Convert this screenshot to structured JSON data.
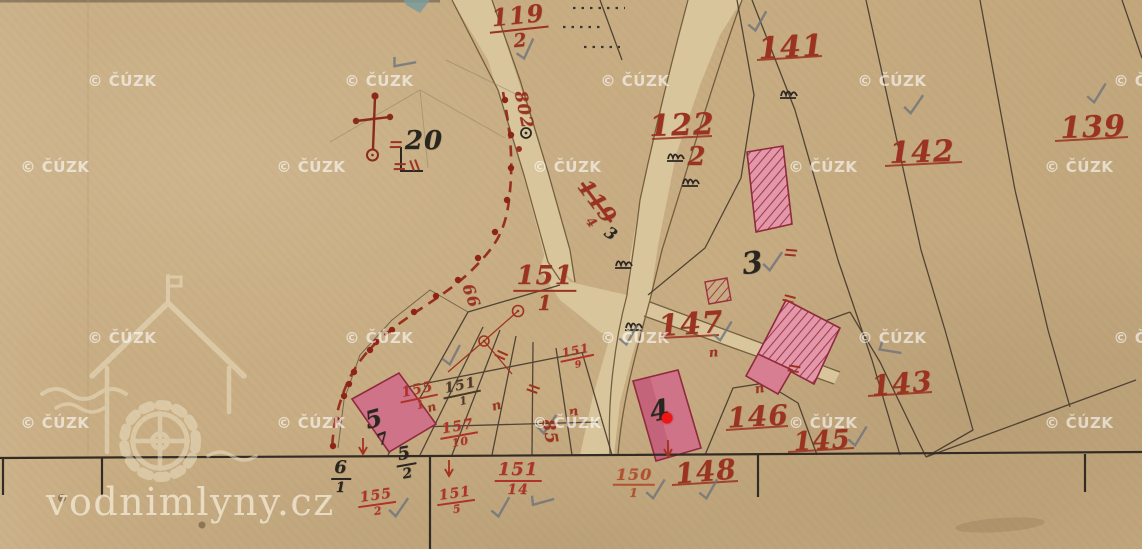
{
  "brand": {
    "text": "vodnimlyny.cz"
  },
  "watermarks": {
    "text": "© ČÚZK",
    "positions": [
      [
        122,
        81
      ],
      [
        379,
        81
      ],
      [
        635,
        81
      ],
      [
        892,
        81
      ],
      [
        1148,
        81
      ],
      [
        55,
        167
      ],
      [
        311,
        167
      ],
      [
        567,
        167
      ],
      [
        823,
        167
      ],
      [
        1079,
        167
      ],
      [
        122,
        338
      ],
      [
        379,
        338
      ],
      [
        635,
        338
      ],
      [
        892,
        338
      ],
      [
        1148,
        338
      ],
      [
        55,
        423
      ],
      [
        311,
        423
      ],
      [
        567,
        423
      ],
      [
        823,
        423
      ],
      [
        1079,
        423
      ]
    ]
  },
  "marker": {
    "color": "#f01414",
    "x": 667,
    "y": 418
  },
  "colors": {
    "paper": "#c9ae84",
    "road": "#d9c59c",
    "ink_red": "#9c3320",
    "ink_black": "#2c2722",
    "building_pink": "#d77e93",
    "building_outline": "#8e2b3c",
    "pencil_grey": "#6e747b",
    "marker_red": "#f01414",
    "watermark_white": "#ffffff"
  },
  "map": {
    "labels": [
      {
        "text": "20",
        "x": 424,
        "y": 141,
        "s": 26,
        "cls": "black"
      },
      {
        "frac": [
          "119",
          "2"
        ],
        "x": 519,
        "y": 27,
        "s": 24,
        "cls": "red",
        "r": -6
      },
      {
        "text": "141",
        "x": 791,
        "y": 48,
        "s": 30,
        "cls": "red",
        "r": -3
      },
      {
        "text": "122",
        "x": 682,
        "y": 126,
        "s": 30,
        "cls": "red",
        "r": -2
      },
      {
        "text": "2",
        "x": 697,
        "y": 157,
        "s": 26,
        "cls": "red",
        "r": 0
      },
      {
        "text": "142",
        "x": 922,
        "y": 153,
        "s": 30,
        "cls": "red",
        "r": -2
      },
      {
        "text": "139",
        "x": 1093,
        "y": 128,
        "s": 30,
        "cls": "red",
        "r": -2
      },
      {
        "text": "119",
        "x": 597,
        "y": 202,
        "s": 22,
        "cls": "red",
        "r": 53,
        "strike": true
      },
      {
        "text": "4",
        "x": 591,
        "y": 223,
        "s": 13,
        "cls": "red",
        "r": 50
      },
      {
        "text": "3",
        "x": 611,
        "y": 234,
        "s": 16,
        "cls": "black",
        "r": 35
      },
      {
        "text": "802",
        "x": 523,
        "y": 110,
        "s": 17,
        "cls": "red",
        "r": 78
      },
      {
        "frac": [
          "151",
          "1"
        ],
        "x": 545,
        "y": 288,
        "s": 26,
        "cls": "red"
      },
      {
        "text": "3",
        "x": 753,
        "y": 264,
        "s": 30,
        "cls": "black",
        "r": -8
      },
      {
        "text": "147",
        "x": 691,
        "y": 325,
        "s": 30,
        "cls": "red",
        "r": -4
      },
      {
        "text": "66",
        "x": 471,
        "y": 296,
        "s": 16,
        "cls": "red",
        "r": 70
      },
      {
        "text": "143",
        "x": 902,
        "y": 384,
        "s": 28,
        "cls": "red",
        "r": -5
      },
      {
        "text": "146",
        "x": 758,
        "y": 417,
        "s": 28,
        "cls": "red",
        "r": -3
      },
      {
        "text": "145",
        "x": 822,
        "y": 441,
        "s": 26,
        "cls": "red",
        "r": -3
      },
      {
        "text": "148",
        "x": 706,
        "y": 472,
        "s": 28,
        "cls": "red",
        "r": -5
      },
      {
        "frac": [
          "150",
          "1"
        ],
        "x": 634,
        "y": 483,
        "s": 16,
        "cls": "orange"
      },
      {
        "frac": [
          "151",
          "14"
        ],
        "x": 518,
        "y": 479,
        "s": 18,
        "cls": "crimson"
      },
      {
        "frac": [
          "151",
          "5"
        ],
        "x": 456,
        "y": 501,
        "s": 14,
        "cls": "crimson",
        "r": -8
      },
      {
        "frac": [
          "155",
          "2"
        ],
        "x": 377,
        "y": 503,
        "s": 14,
        "cls": "crimson",
        "r": -8
      },
      {
        "frac": [
          "6",
          "1"
        ],
        "x": 341,
        "y": 477,
        "s": 18,
        "cls": "black"
      },
      {
        "frac": [
          "5",
          "2"
        ],
        "x": 406,
        "y": 463,
        "s": 18,
        "cls": "black",
        "r": -10
      },
      {
        "frac": [
          "155",
          "1"
        ],
        "x": 419,
        "y": 397,
        "s": 14,
        "cls": "crimson",
        "r": -12
      },
      {
        "frac": [
          "151",
          "1"
        ],
        "x": 462,
        "y": 393,
        "s": 14,
        "cls": "dark",
        "r": -12
      },
      {
        "frac": [
          "157",
          "10"
        ],
        "x": 459,
        "y": 434,
        "s": 14,
        "cls": "crimson",
        "r": -10
      },
      {
        "frac": [
          "151",
          "9"
        ],
        "x": 577,
        "y": 357,
        "s": 12,
        "cls": "crimson",
        "r": -12
      },
      {
        "text": "4",
        "x": 660,
        "y": 411,
        "s": 28,
        "cls": "black",
        "r": -12
      },
      {
        "text": "5",
        "x": 374,
        "y": 419,
        "s": 24,
        "cls": "black",
        "r": -15
      },
      {
        "text": "7",
        "x": 383,
        "y": 439,
        "s": 16,
        "cls": "black",
        "r": -20
      },
      {
        "text": "85",
        "x": 549,
        "y": 432,
        "s": 17,
        "cls": "red",
        "r": 80
      },
      {
        "text": "п",
        "x": 714,
        "y": 353,
        "s": 13,
        "cls": "red",
        "r": -5,
        "mark": true
      },
      {
        "text": "п",
        "x": 760,
        "y": 389,
        "s": 13,
        "cls": "red",
        "r": -10,
        "mark": true
      },
      {
        "text": "п",
        "x": 497,
        "y": 406,
        "s": 13,
        "cls": "red",
        "r": -15,
        "mark": true
      },
      {
        "text": "п",
        "x": 574,
        "y": 412,
        "s": 13,
        "cls": "red",
        "r": -10,
        "mark": true
      },
      {
        "text": "п",
        "x": 432,
        "y": 407,
        "s": 12,
        "cls": "red",
        "r": -15,
        "mark": true
      }
    ],
    "checks": [
      [
        757,
        22,
        -10
      ],
      [
        913,
        105,
        -5
      ],
      [
        1096,
        94,
        -8
      ],
      [
        525,
        50,
        -15
      ],
      [
        402,
        62,
        40
      ],
      [
        772,
        262,
        -5
      ],
      [
        722,
        332,
        -8
      ],
      [
        628,
        336,
        -10
      ],
      [
        451,
        356,
        -12
      ],
      [
        546,
        425,
        -5
      ],
      [
        655,
        490,
        -8
      ],
      [
        708,
        490,
        -10
      ],
      [
        398,
        508,
        -5
      ],
      [
        500,
        508,
        -10
      ],
      [
        540,
        500,
        35
      ],
      [
        857,
        437,
        -8
      ],
      [
        888,
        348,
        60
      ]
    ],
    "red_arrows": [
      [
        363,
        447
      ],
      [
        449,
        469
      ],
      [
        668,
        449
      ]
    ],
    "red_ticks": [
      [
        395,
        146,
        10
      ],
      [
        399,
        168,
        10
      ],
      [
        413,
        165,
        80
      ],
      [
        500,
        356,
        35
      ],
      [
        532,
        390,
        30
      ],
      [
        790,
        254,
        15
      ],
      [
        788,
        300,
        25
      ],
      [
        793,
        370,
        20
      ]
    ],
    "boundary_dots": [
      [
        505,
        100
      ],
      [
        511,
        135
      ],
      [
        511,
        168
      ],
      [
        507,
        200
      ],
      [
        495,
        232
      ],
      [
        478,
        258
      ],
      [
        458,
        280
      ],
      [
        436,
        296
      ],
      [
        414,
        312
      ],
      [
        392,
        330
      ],
      [
        370,
        350
      ],
      [
        354,
        372
      ],
      [
        344,
        396
      ],
      [
        337,
        420
      ],
      [
        333,
        446
      ],
      [
        376,
        342
      ],
      [
        349,
        384
      ]
    ],
    "tufts": [
      [
        788,
        92
      ],
      [
        675,
        155
      ],
      [
        690,
        180
      ],
      [
        623,
        262
      ],
      [
        633,
        324
      ]
    ]
  }
}
